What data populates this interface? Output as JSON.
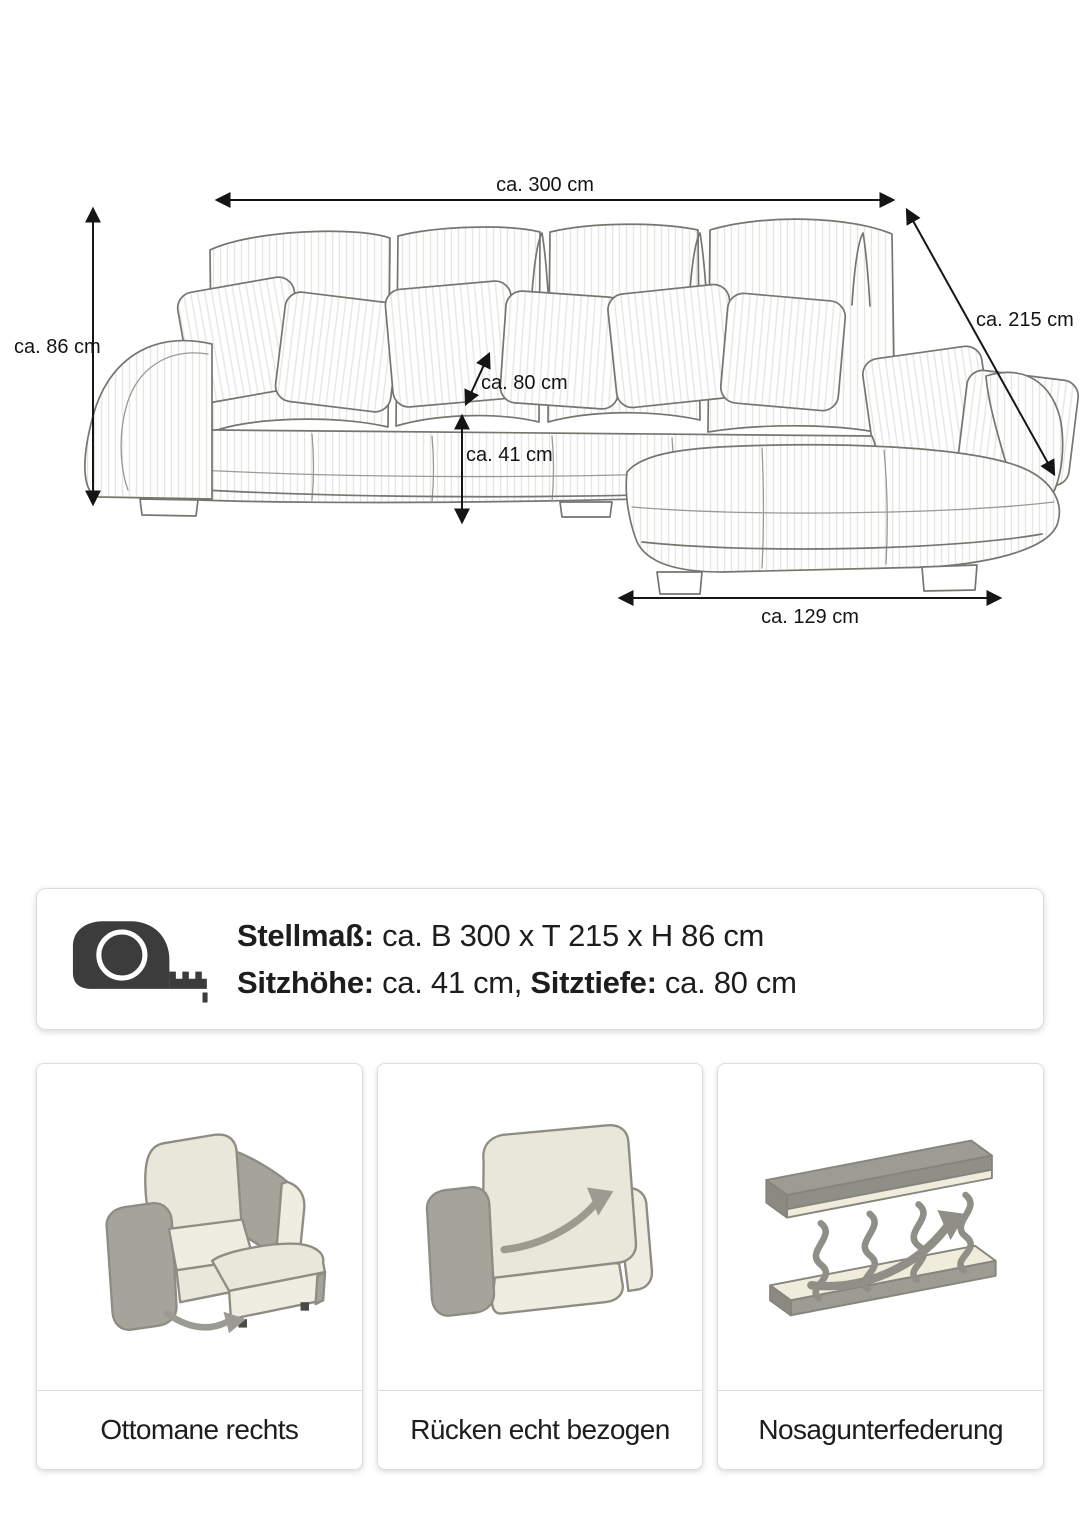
{
  "diagram": {
    "dim_width": "ca. 300 cm",
    "dim_depth": "ca. 215 cm",
    "dim_height": "ca. 86 cm",
    "dim_seat_depth": "ca. 80 cm",
    "dim_seat_height": "ca. 41 cm",
    "dim_ottoman_width": "ca. 129 cm"
  },
  "info_card": {
    "line1_label": "Stellmaß:",
    "line1_value": " ca. B 300 x T 215 x H 86 cm",
    "line2_label1": "Sitzhöhe:",
    "line2_value1": " ca. 41 cm, ",
    "line2_label2": "Sitztiefe:",
    "line2_value2": " ca. 80 cm"
  },
  "feature_cards": [
    {
      "icon": "ottoman-right-illustration",
      "label": "Ottomane rechts"
    },
    {
      "icon": "back-upholstered-illustration",
      "label": "Rücken echt bezogen"
    },
    {
      "icon": "nosag-springs-illustration",
      "label": "Nosagunterfederung"
    }
  ],
  "colors": {
    "text": "#1d1d1b",
    "card_border": "#dddddd",
    "sketch_stroke": "#76766f",
    "dimension_line": "#151515",
    "icon_dark": "#3c3c3c",
    "illustration_beige": "#e9e6da",
    "illustration_gray": "#a4a49a",
    "illustration_cream": "#efece1"
  }
}
